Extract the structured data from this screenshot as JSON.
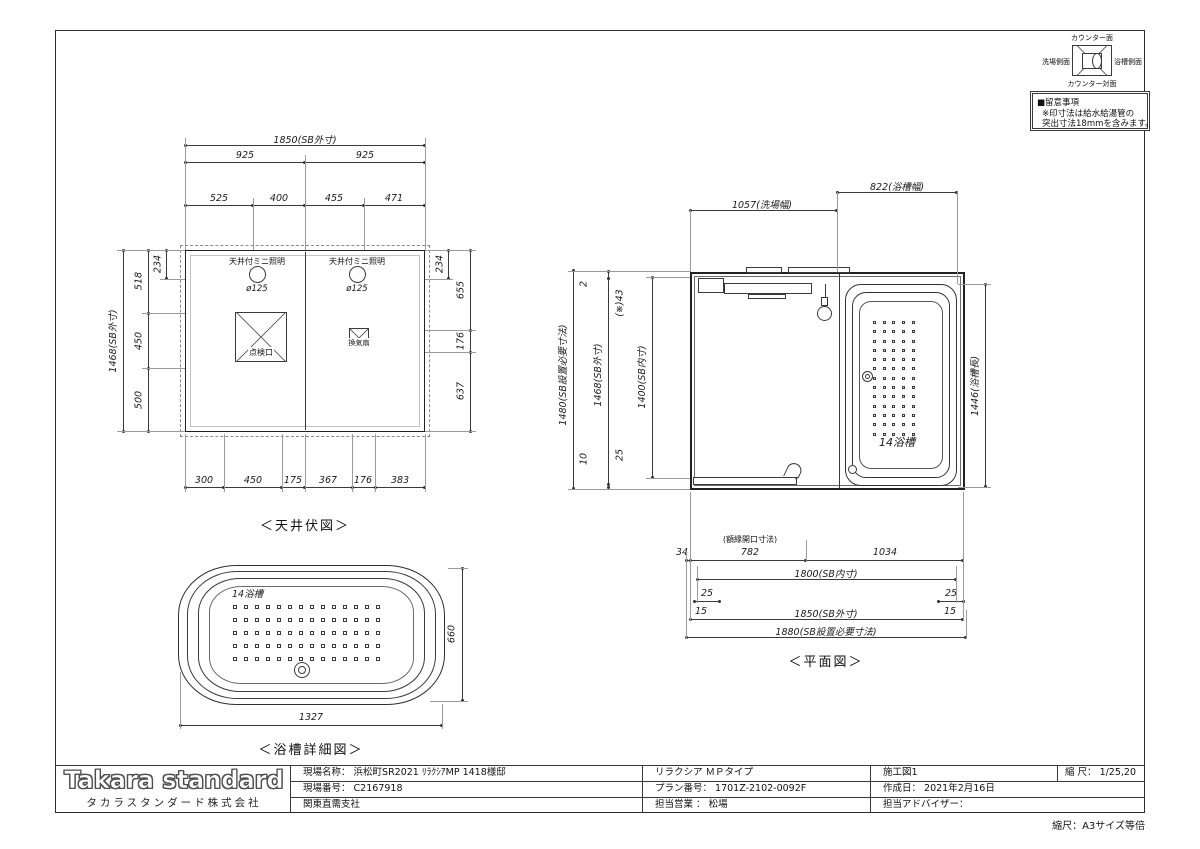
{
  "orientation_key": {
    "top": "カウンター面",
    "left": "洗場側面",
    "right": "浴槽側面",
    "bottom": "カウンター対面"
  },
  "notice": {
    "title": "■留意事項",
    "line1": "※印寸法は給水給湯管の",
    "line2": "突出寸法18mmを含みます。"
  },
  "ceiling_plan": {
    "caption": "＜天井伏図＞",
    "light_label": "天井付ミニ照明",
    "light_diameter": "ø125",
    "hatch_label": "点検口",
    "fan_label": "換気扇",
    "dim_total_width": "1850(SB外寸)",
    "dim_half_left": "925",
    "dim_half_right": "925",
    "top_segments": [
      "525",
      "400",
      "455",
      "471"
    ],
    "dim_left_total": "1468(SB外寸)",
    "dim_left_sub": "234",
    "left_segments": [
      "518",
      "450",
      "500"
    ],
    "dim_right_sub": "234",
    "right_segments": [
      "655",
      "176",
      "637"
    ],
    "bottom_segments": [
      "300",
      "450",
      "175",
      "367",
      "176",
      "383"
    ]
  },
  "floor_plan": {
    "caption": "＜平面図＞",
    "tub_label": "14浴槽",
    "dim_bath_width": "822(浴槽幅)",
    "dim_wash_width": "1057(洗場幅)",
    "dim_left_outer": "1480(SB設置必要寸法)",
    "dim_left_outer_top": "2",
    "dim_left_outer_bottom": "10",
    "dim_left_mid": "1468(SB外寸)",
    "dim_left_mid_top": "(※)43",
    "dim_left_mid_bottom": "25",
    "dim_left_inner": "1400(SB内寸)",
    "dim_right": "1446(浴槽長)",
    "opening_label": "(額縁開口寸法)",
    "row1_segments": [
      "34",
      "782",
      "1034"
    ],
    "row2": "1800(SB内寸)",
    "row3_left": "25",
    "row3_right": "25",
    "row4_left": "15",
    "row4_center": "1850(SB外寸)",
    "row4_right": "15",
    "row5": "1880(SB設置必要寸法)"
  },
  "tub_detail": {
    "caption": "＜浴槽詳細図＞",
    "label": "14浴槽",
    "dim_height": "660",
    "dim_width": "1327"
  },
  "title_block": {
    "logo": "Takara standard",
    "company": "タカラスタンダード株式会社",
    "site_name_label": "現場名称：",
    "site_name": "浜松町SR2021 ﾘﾗｸｼｱMP 1418様邸",
    "site_no_label": "現場番号：",
    "site_no": "C2167918",
    "branch": "関東直需支社",
    "product": "リラクシア ＭＰタイプ",
    "plan_no_label": "プラン番号：",
    "plan_no": "1701Z-2102-0092F",
    "sales_label": "担当営業 ：",
    "sales": "松場",
    "sheet": "施工図1",
    "scale_label": "縮 尺：",
    "scale": "1/25,20",
    "date_label": "作成日：",
    "date": "2021年2月16日",
    "advisor_label": "担当アドバイザー：",
    "footer_scale": "縮尺：A3サイズ等倍"
  }
}
